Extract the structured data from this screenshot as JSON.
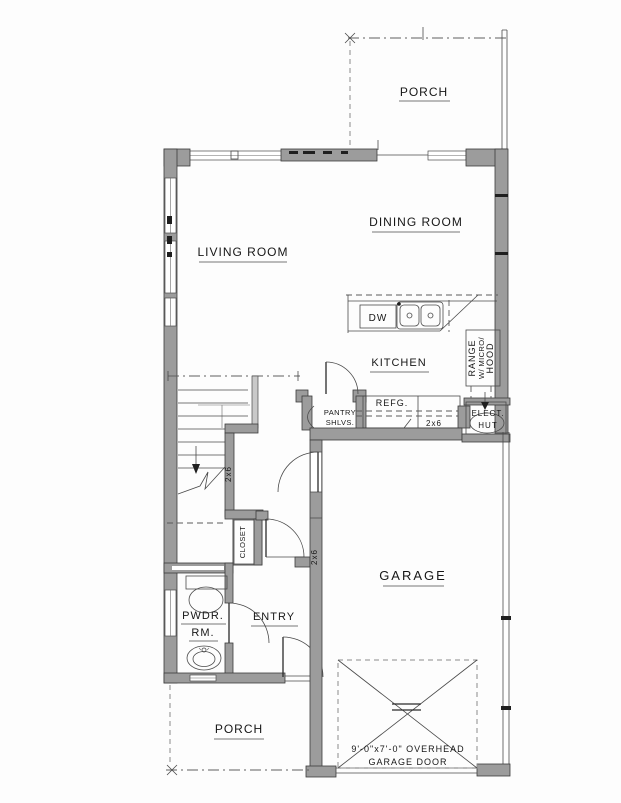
{
  "drawing_type": "residential floor plan",
  "colors": {
    "background": "#fdfdfd",
    "wall_fill": "#9c9c9c",
    "line": "#4a4a4a",
    "text": "#171717"
  },
  "rooms": {
    "porch_top": "PORCH",
    "dining": "DINING ROOM",
    "living": "LIVING ROOM",
    "kitchen": "KITCHEN",
    "garage": "GARAGE",
    "entry": "ENTRY",
    "powder_1": "PWDR.",
    "powder_2": "RM.",
    "closet": "CLOSET",
    "porch_bottom": "PORCH"
  },
  "fixtures": {
    "dishwasher": "DW",
    "refrigerator": "REFG.",
    "pantry_1": "PANTRY",
    "pantry_2": "SHLVS.",
    "range_1": "RANGE",
    "range_2": "W/ MICRO/",
    "range_3": "HOOD",
    "elect_1": "ELECT.",
    "elect_2": "HUT"
  },
  "notes": {
    "stud_stair": "2x6",
    "stud_garage": "2x6",
    "stud_kitchen": "2x6",
    "garage_door_1": "9'-0\"x7'-0\" OVERHEAD",
    "garage_door_2": "GARAGE DOOR"
  }
}
